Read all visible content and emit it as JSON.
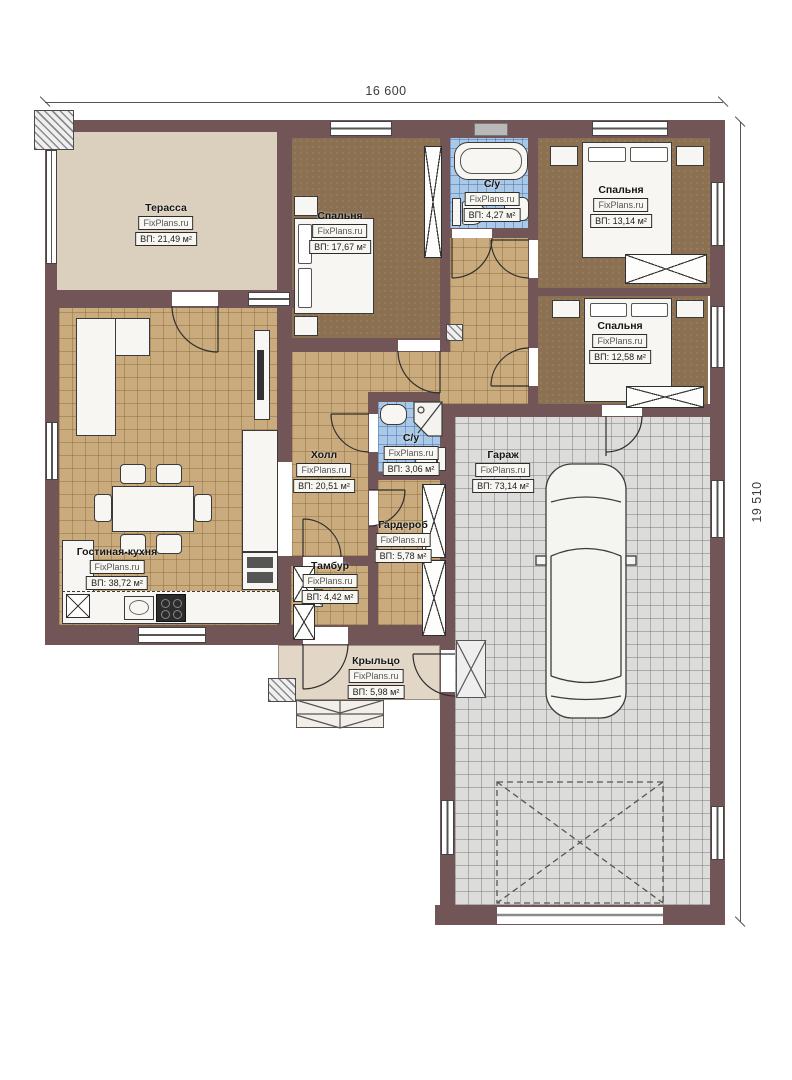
{
  "plan": {
    "watermark": "FixPlans.ru",
    "dimensions": {
      "width": "16 600",
      "height": "19 510"
    },
    "rooms": [
      {
        "id": "terrace",
        "name": "Терасса",
        "area": "ВП: 21,49 м²"
      },
      {
        "id": "bedroom-1",
        "name": "Спальня",
        "area": "ВП: 17,67 м²"
      },
      {
        "id": "bathroom-1",
        "name": "С/у",
        "area": "ВП: 4,27 м²"
      },
      {
        "id": "bedroom-2",
        "name": "Спальня",
        "area": "ВП: 13,14 м²"
      },
      {
        "id": "bedroom-3",
        "name": "Спальня",
        "area": "ВП: 12,58 м²"
      },
      {
        "id": "hall",
        "name": "Холл",
        "area": "ВП: 20,51 м²"
      },
      {
        "id": "bathroom-2",
        "name": "С/у",
        "area": "ВП: 3,06 м²"
      },
      {
        "id": "garage",
        "name": "Гараж",
        "area": "ВП: 73,14 м²"
      },
      {
        "id": "wardrobe",
        "name": "Гардероб",
        "area": "ВП: 5,78 м²"
      },
      {
        "id": "vestibule",
        "name": "Тамбур",
        "area": "ВП: 4,42 м²"
      },
      {
        "id": "living-kitchen",
        "name": "Гостиная-кухня",
        "area": "ВП: 38,72 м²"
      },
      {
        "id": "porch",
        "name": "Крыльцо",
        "area": "ВП: 5,98 м²"
      }
    ],
    "colors": {
      "wall": "#715557",
      "terrace_floor": "#dbcfbe",
      "tile_floor": "#c9ab7d",
      "bedroom_floor": "#8b7152",
      "bathroom_floor": "#aac9e8",
      "garage_floor": "#dcdcda"
    }
  }
}
